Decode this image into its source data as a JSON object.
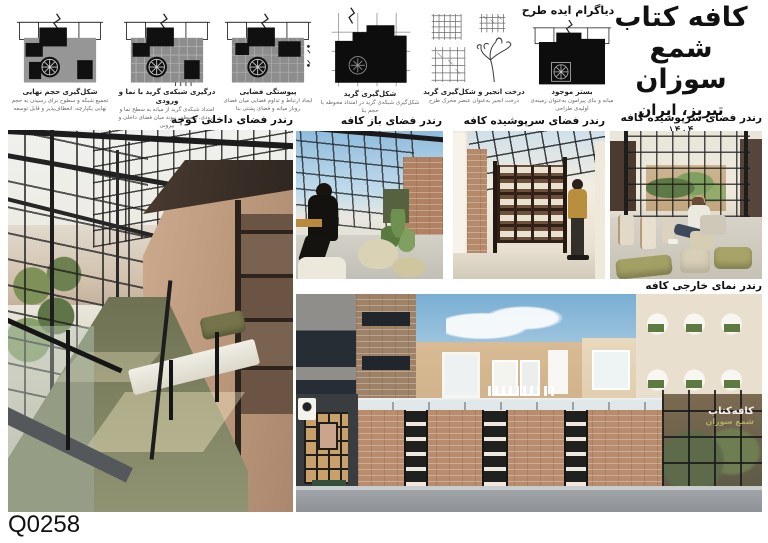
{
  "sheet": {
    "id_label": "Q0258"
  },
  "title_block": {
    "title_line1": "کافه کتاب",
    "title_line2": "شمع سوزان",
    "location": "تبریز، ایران",
    "year": "۱۴۰۴"
  },
  "diagrams": {
    "header": "دیاگرام ایده طرح",
    "items": [
      {
        "caption": "شکل‌گیری حجم نهایی",
        "desc": "تجمیع شبکه و سطوح برای رسیدن به حجم نهایی یکپارچه، انعطاف‌پذیر و قابل توسعه"
      },
      {
        "caption": "درگیری شبکه‌ی گرید با نما و ورودی",
        "desc": "امتداد شبکه‌ی گرید از میانه به سطح نما و ورودی، به‌منظور پیوند میان فضای داخلی و بیرونی"
      },
      {
        "caption": "پیوستگی فضایی",
        "desc": "ایجاد ارتباط و تداوم فضایی میان فضای روباز میانه و فضای پشتی بنا"
      },
      {
        "caption": "شکل‌گیری گرید",
        "desc": "شکل‌گیری شبکه‌ی گرید در امتداد محوطه با حجم بنا"
      },
      {
        "caption": "درخت انجیر و شکل‌گیری گرید",
        "desc": "درخت انجیر به‌عنوان عنصر محرک طرح"
      },
      {
        "caption": "بستر موجود",
        "desc": "میانه و بنای پیرامون به‌عنوان زمینه‌ی اولیه‌ی طراحی"
      }
    ]
  },
  "render_labels": {
    "alley": "رندر فضای داخلی کوچه",
    "open": "رندر فضای باز کافه",
    "covered_a": "رندر فضای سرپوشیده کافه",
    "covered_b": "رندر فضای سرپوشیده کافه",
    "exterior": "رندر نمای خارجی کافه"
  },
  "facade_sign": {
    "line1": "کافه‌کتاب",
    "line2": "شمع سوزان"
  },
  "colors": {
    "carpet_green": "#7b7f5e",
    "brick": "#b5876a",
    "steel": "#2b2b2b",
    "sky": "#8fbcdd",
    "olive_accent": "#8a8a52"
  }
}
